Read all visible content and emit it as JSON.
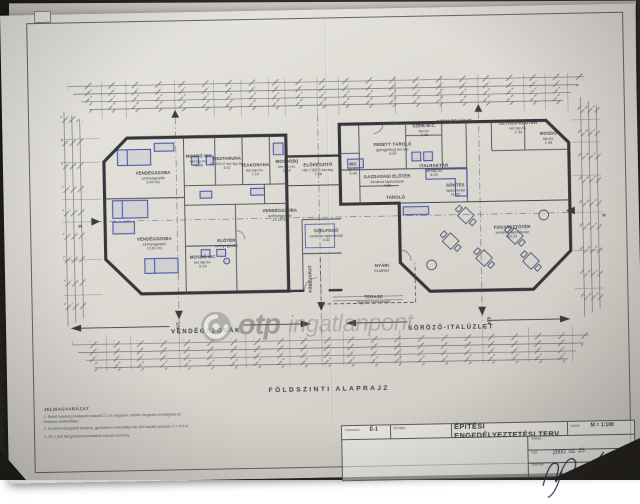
{
  "colors": {
    "paper": "#dedbd5",
    "ink": "#3e3e46",
    "furniture_blue": "#3b4da8",
    "watermark_gray": "#8f8e8c",
    "background": "#35322e"
  },
  "watermark": {
    "bold": "otp",
    "light": "ingatlanpont"
  },
  "plan": {
    "title": "FÖLDSZINTI ALAPRAJZ",
    "zones": [
      {
        "label": "VENDÉGSZOBÁK",
        "x": 200,
        "y": 320
      },
      {
        "label": "SÖRÖZŐ-ITALÜZLET",
        "x": 445,
        "y": 321
      }
    ],
    "axis_markers": {
      "bottom": [
        {
          "label": "K/1",
          "x": 172,
          "y": 313
        },
        {
          "label": "K/2",
          "x": 483,
          "y": 314
        }
      ],
      "sides": [
        {
          "label": "H",
          "x": 76,
          "y": 212
        },
        {
          "label": "H",
          "x": 600,
          "y": 211
        }
      ]
    },
    "rooms": [
      {
        "name": "VENDÉGSZOBA",
        "floor": "szőnyegpadló",
        "area": "9.44 m2",
        "x": 150,
        "y": 165
      },
      {
        "name": "MOSDÓ WC",
        "floor": "ker.lap.bu.",
        "area": "3.98",
        "x": 196,
        "y": 149
      },
      {
        "name": "TISZTARUHA",
        "floor": "TÁROLÓ ker.lap.bu.",
        "area": "4.57",
        "x": 224,
        "y": 152
      },
      {
        "name": "TEAKONYHA",
        "floor": "ker.lap.bu.",
        "area": "7.14",
        "x": 252,
        "y": 159
      },
      {
        "name": "MOSDÓ(k)",
        "floor": "ker.lap.bu.",
        "area": "6.84",
        "x": 284,
        "y": 156
      },
      {
        "name": "ELŐKÉSZÍTŐ",
        "floor": "HELYISÉG ker.lap.",
        "area": "7.28",
        "x": 315,
        "y": 160
      },
      {
        "name": "VENDÉGSZOBA",
        "floor": "szőnyegpadló",
        "area": "13.14 m2",
        "x": 276,
        "y": 205
      },
      {
        "name": "VENDÉGSZOBA",
        "floor": "szőnyegpadló",
        "area": "13.61 m2",
        "x": 150,
        "y": 231
      },
      {
        "name": "MOSDÓ WC",
        "floor": "ker.lap.bu.",
        "area": "5.04",
        "x": 198,
        "y": 250
      },
      {
        "name": "ELŐTÉR",
        "floor": "szőnyegpadló",
        "area": "",
        "x": 222,
        "y": 232
      },
      {
        "name": "SZÉLFOGÓ",
        "floor": "kerámia lapburkolat",
        "area": "4.62",
        "x": 322,
        "y": 226
      },
      {
        "name": "GAZD.BEJÁRAT",
        "floor": "",
        "area": "",
        "x": 383,
        "y": 116
      },
      {
        "name": "SZEM.BEJÁRAT",
        "floor": "",
        "area": "",
        "x": 452,
        "y": 115
      },
      {
        "name": "SZEM.W.C.",
        "floor": "lap.bu.",
        "area": "1.26",
        "x": 422,
        "y": 123
      },
      {
        "name": "FEDETT TÁROLÓ",
        "floor": "(göngyöleg) ker.lap.",
        "area": "4.44",
        "x": 390,
        "y": 141
      },
      {
        "name": "WC",
        "floor": "lap.bu.",
        "area": "0.98",
        "x": 350,
        "y": 160
      },
      {
        "name": "GAZDASÁGI ELŐTÉR",
        "floor": "kerámia lapburkolat",
        "area": "4.65",
        "x": 384,
        "y": 173
      },
      {
        "name": "ITALRAKTÁR",
        "floor": "ker.lap.bu.",
        "area": "8.42",
        "x": 431,
        "y": 163
      },
      {
        "name": "TÁROLÓ",
        "floor": "",
        "area": "",
        "x": 392,
        "y": 190
      },
      {
        "name": "ÖLTÖZŐ-ELŐTÉR",
        "floor": "ker.lap.bu.",
        "area": "2.34",
        "x": 516,
        "y": 122
      },
      {
        "name": "MOSDÓ",
        "floor": "lap.bu.",
        "area": "1.98",
        "x": 546,
        "y": 133
      },
      {
        "name": "SÖNTÉS",
        "floor": "lapburkolat",
        "area": "11.52",
        "x": 452,
        "y": 183
      },
      {
        "name": "FOGYASZTÓTÉR",
        "floor": "kerámia lapburkolat",
        "area": "63.24",
        "x": 508,
        "y": 226
      },
      {
        "name": "NYÁRI",
        "floor": "KIJÁRAT",
        "area": "",
        "x": 377,
        "y": 260
      },
      {
        "name": "TERASZ",
        "floor": "fagyálló lapburkolat",
        "area": "",
        "x": 368,
        "y": 291
      },
      {
        "name": "FŐBEJÁRAT",
        "floor": "",
        "area": "",
        "x": 306,
        "y": 269,
        "vertical": true
      }
    ]
  },
  "legend": {
    "title": "JELMAGYARÁZAT",
    "items": [
      "1. Belső helyiség elválasztó falazott 2.1 m magasan, felette üvegezés bevilágítás és keskeny szellőzőkkel.",
      "2. Kívülről hőszigetelt kémény, gyorsbeton burkolattal NÁ 300 saválló acélcső, h = 9.0 m.",
      "3. HT-1 jelű fali gázbetonelemekből szerelt szekrény."
    ]
  },
  "title_block": {
    "torzsszam_label": "Törzsszám:",
    "torzsszam_value": "É-1",
    "tervfajta_label": "Tervfajta:",
    "doc_title": "ÉPÍTÉSI ENGEDÉLYEZTETÉSI TERV",
    "scale_label": "Lépték",
    "scale_value": "M = 1:100",
    "sign_label": "Aláírás:",
    "date_label": "Kelt:",
    "date_value": "2000. 02. 25.",
    "copy_label": "Másolás:"
  }
}
